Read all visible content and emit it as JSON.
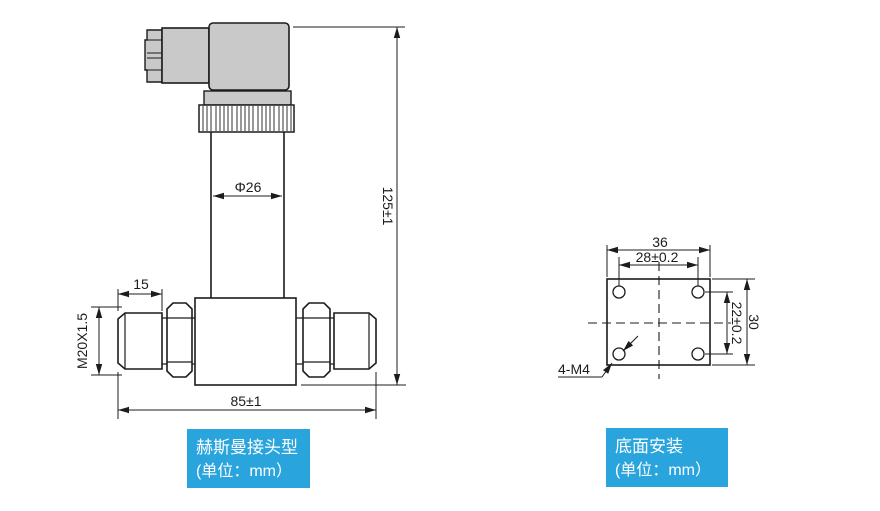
{
  "left_figure": {
    "caption": {
      "line1": "赫斯曼接头型",
      "line2": "(单位：mm）"
    },
    "dimensions": {
      "diameter": "Φ26",
      "height": "125±1",
      "thread_length": "15",
      "thread_spec": "M20X1.5",
      "total_length": "85±1"
    }
  },
  "right_figure": {
    "caption": {
      "line1": "底面安装",
      "line2": "(单位：mm）"
    },
    "dimensions": {
      "width": "36",
      "hole_spacing_horizontal": "28±0.2",
      "hole_spacing_vertical": "22±0.2",
      "height": "30",
      "mounting_holes": "4-M4"
    }
  },
  "colors": {
    "label_background": "#29a4dd",
    "label_text": "#ffffff",
    "part_fill": "#c9c9c9",
    "line_color": "#1c1c1c"
  }
}
